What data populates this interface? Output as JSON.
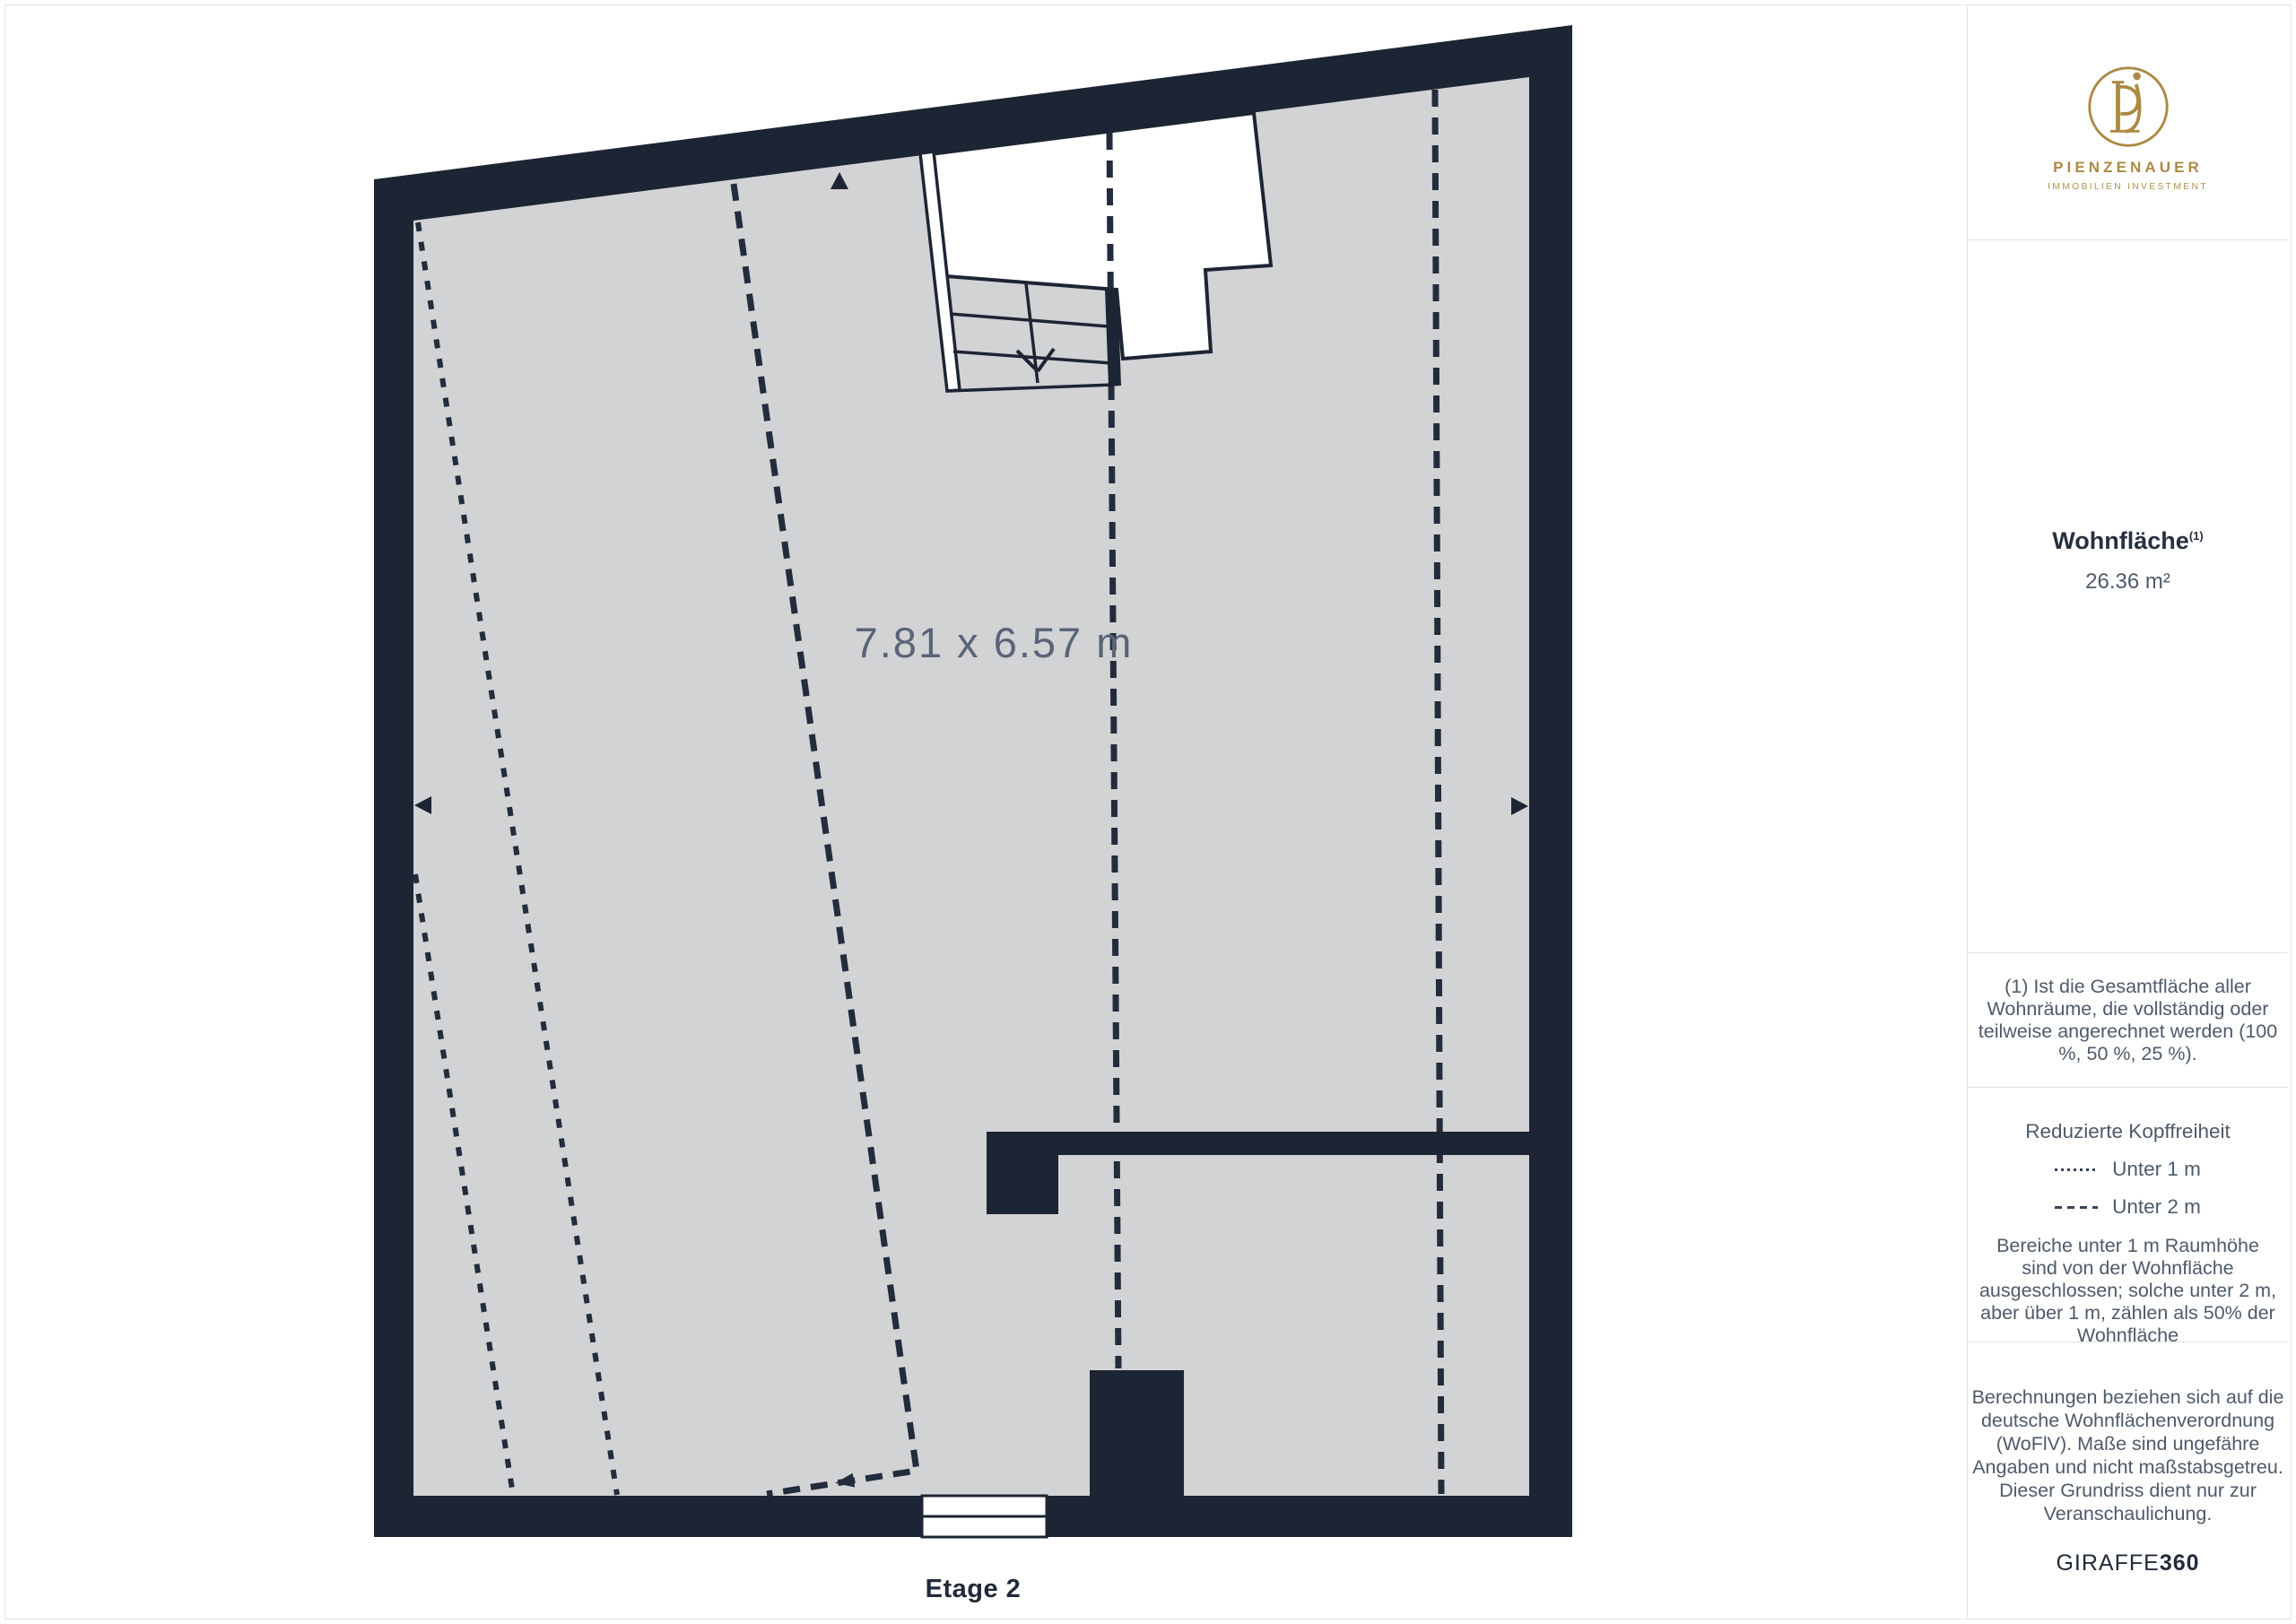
{
  "colors": {
    "wall": "#1d2433",
    "floor": "#d2d3d4",
    "line_dark": "#232c3d",
    "dimension_text": "#5a6477",
    "gold": "#ac8a44",
    "divider": "#e3e3e3"
  },
  "floorplan": {
    "dimension_label": "7.81 x 6.57 m",
    "floor_label": "Etage 2"
  },
  "sidebar": {
    "logo": {
      "brand": "PIENZENAUER",
      "tagline": "IMMOBILIEN INVESTMENT"
    },
    "area": {
      "title": "Wohnfläche",
      "title_superscript": "(1)",
      "value": "26.36 m²"
    },
    "footnote": {
      "text": "(1) Ist die Gesamtfläche aller Wohnräume, die vollständig oder teilweise angerechnet werden (100 %, 50 %, 25 %)."
    },
    "legend": {
      "title": "Reduzierte Kopffreiheit",
      "items": [
        {
          "style": "dotted",
          "label": "Unter 1 m"
        },
        {
          "style": "dashed",
          "label": "Unter 2 m"
        }
      ],
      "note": "Bereiche unter 1 m Raumhöhe sind von der Wohnfläche ausgeschlossen; solche unter 2 m, aber über 1 m, zählen als 50% der Wohnfläche"
    },
    "disclaimer": {
      "text": "Berechnungen beziehen sich auf die deutsche Wohnflächenverordnung (WoFlV). Maße sind ungefähre Angaben und nicht maßstabsgetreu. Dieser Grundriss dient nur zur Veranschaulichung."
    },
    "watermark": {
      "brand": "GIRAFFE",
      "suffix": "360"
    }
  }
}
